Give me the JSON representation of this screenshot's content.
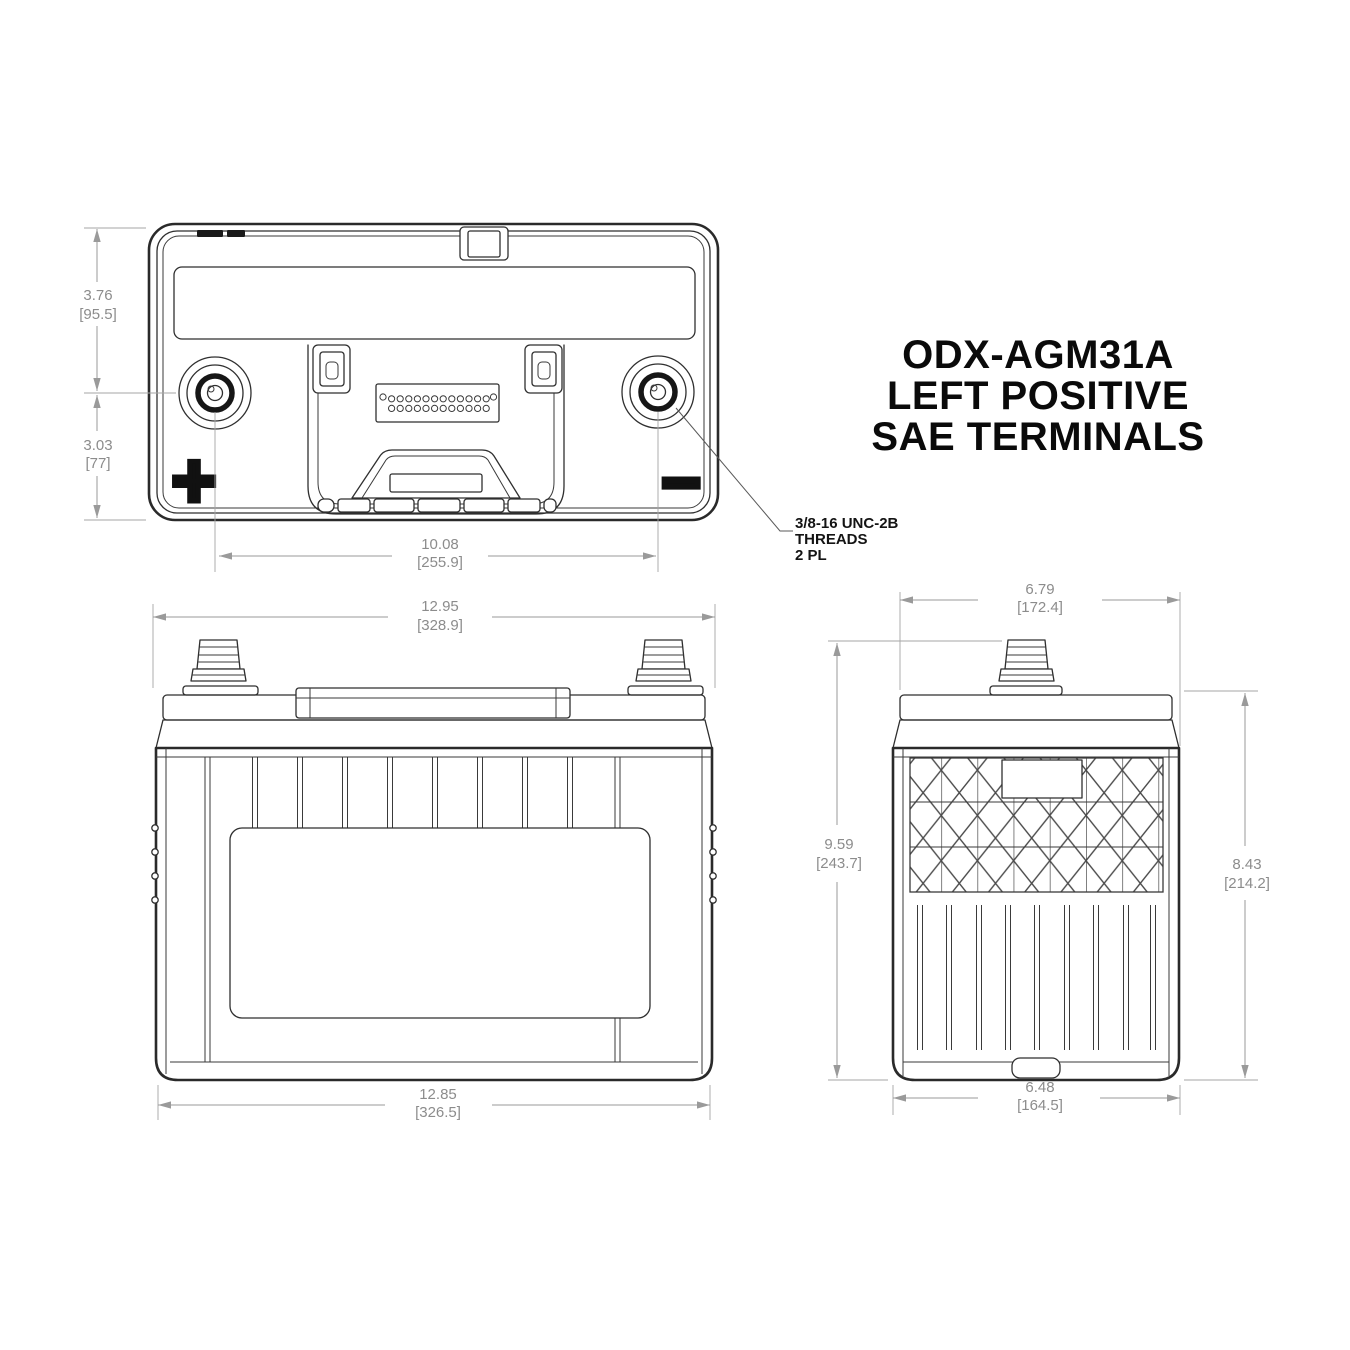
{
  "drawing": {
    "title": {
      "line1": "ODX-AGM31A",
      "line2": "LEFT POSITIVE",
      "line3": "SAE TERMINALS"
    },
    "callout": {
      "line1": "3/8-16 UNC-2B",
      "line2": "THREADS",
      "line3": "2 PL"
    },
    "symbols": {
      "positive": "+",
      "negative": "−"
    },
    "dims": {
      "top_height_upper": {
        "in": "3.76",
        "mm": "[95.5]"
      },
      "top_height_lower": {
        "in": "3.03",
        "mm": "[77]"
      },
      "terminal_spacing": {
        "in": "10.08",
        "mm": "[255.9]"
      },
      "front_width_top": {
        "in": "12.95",
        "mm": "[328.9]"
      },
      "front_width_bottom": {
        "in": "12.85",
        "mm": "[326.5]"
      },
      "side_width_top": {
        "in": "6.79",
        "mm": "[172.4]"
      },
      "side_height_overall": {
        "in": "9.59",
        "mm": "[243.7]"
      },
      "side_height_case": {
        "in": "8.43",
        "mm": "[214.2]"
      },
      "side_width_bottom": {
        "in": "6.48",
        "mm": "[164.5]"
      }
    },
    "colors": {
      "outline": "#2F2F2F",
      "dimension_lines": "#9A9A9A",
      "dimension_text": "#8C8C8C",
      "text": "#0A0A0A",
      "background": "#FFFFFF"
    }
  }
}
